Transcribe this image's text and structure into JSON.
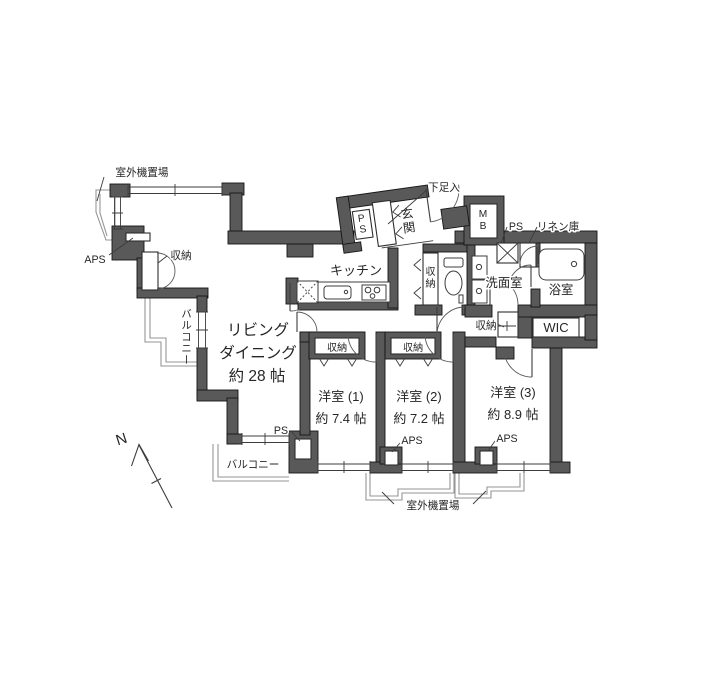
{
  "meta": {
    "type": "japanese-apartment-floor-plan"
  },
  "colors": {
    "wall": "#595959",
    "outline": "#161616",
    "thin_line": "#3c3c3c",
    "light_line": "#969696",
    "text": "#262626"
  },
  "rooms": {
    "living": {
      "line1": "リビング",
      "line2": "ダイニング",
      "size": "約 28 帖"
    },
    "kitchen": {
      "name": "キッチン"
    },
    "genkan": {
      "c1": "玄",
      "c2": "関"
    },
    "bed1": {
      "name": "洋室 (1)",
      "size": "約 7.4 帖"
    },
    "bed2": {
      "name": "洋室 (2)",
      "size": "約 7.2 帖"
    },
    "bed3": {
      "name": "洋室 (3)",
      "size": "約 8.9 帖"
    },
    "washroom": {
      "name": "洗面室"
    },
    "bathroom": {
      "name": "浴室"
    },
    "wic": {
      "name": "WIC"
    }
  },
  "closets": {
    "left": "収納",
    "toilet": {
      "c1": "収",
      "c2": "納"
    },
    "hall": "収納",
    "bed1": "収納",
    "bed2": "収納",
    "shoe": "下足入",
    "linen": "リネン庫"
  },
  "service": {
    "ps_entrance": {
      "c1": "P",
      "c2": "S"
    },
    "ps_right": "PS",
    "ps_bottom": "PS",
    "mb": {
      "c1": "M",
      "c2": "B"
    },
    "aps_left": "APS",
    "aps_bed2": "APS",
    "aps_bed3": "APS",
    "outdoor_top": "室外機置場",
    "outdoor_bottom": "室外機置場"
  },
  "balconies": {
    "left": "バルコニー",
    "bottom": "バルコニー"
  },
  "compass": {
    "label": "N"
  }
}
